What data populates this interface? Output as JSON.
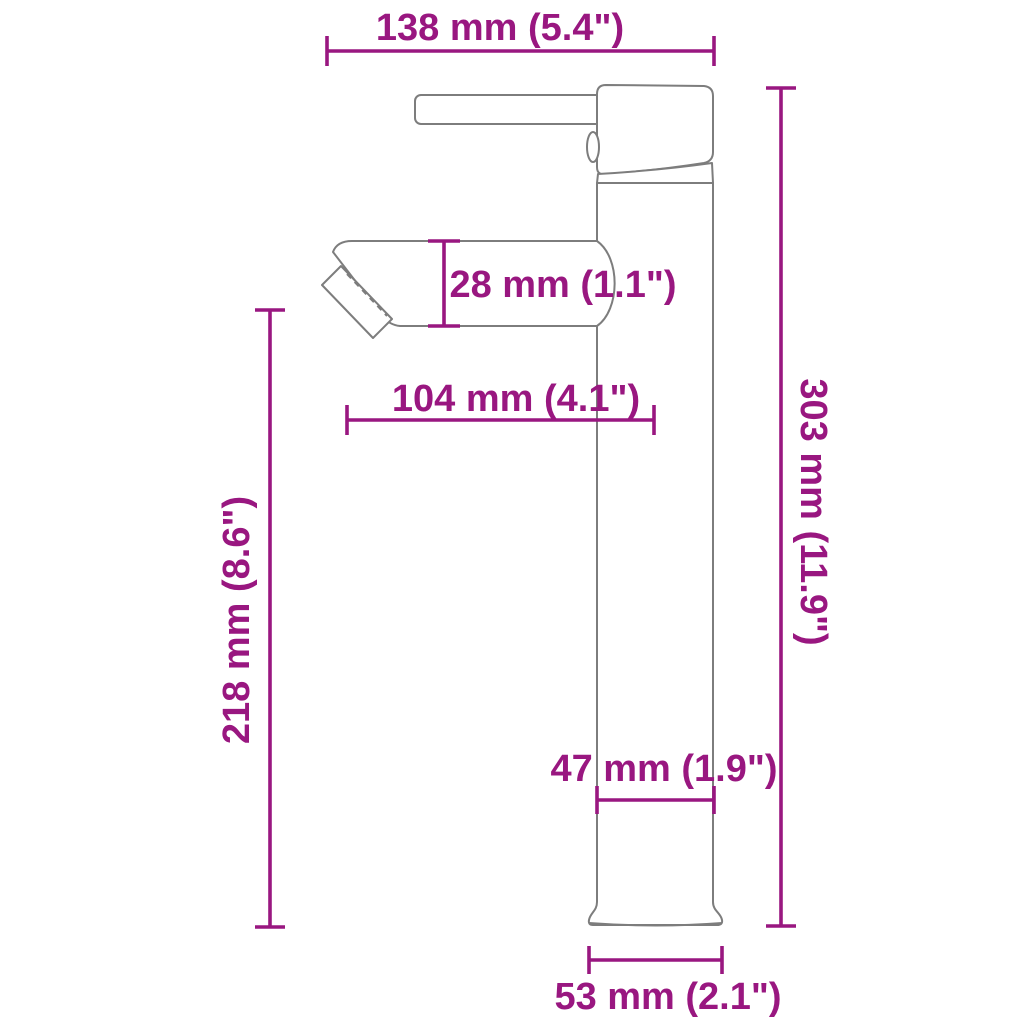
{
  "diagram": {
    "subject": "tall single-lever basin faucet side view dimension drawing",
    "accent_color": "#991780",
    "outline_color": "#7D7D7D",
    "background_color": "#FFFFFF",
    "dimensions": {
      "top_width": {
        "label": "138 mm (5.4\")",
        "mm": 138,
        "inches": 5.4,
        "orientation": "horizontal"
      },
      "spout_height": {
        "label": "28 mm (1.1\")",
        "mm": 28,
        "inches": 1.1,
        "orientation": "vertical"
      },
      "spout_reach": {
        "label": "104 mm (4.1\")",
        "mm": 104,
        "inches": 4.1,
        "orientation": "horizontal"
      },
      "spout_to_base_height": {
        "label": "218 mm (8.6\")",
        "mm": 218,
        "inches": 8.6,
        "orientation": "vertical"
      },
      "total_height": {
        "label": "303 mm (11.9\")",
        "mm": 303,
        "inches": 11.9,
        "orientation": "vertical"
      },
      "body_width": {
        "label": "47 mm (1.9\")",
        "mm": 47,
        "inches": 1.9,
        "orientation": "horizontal"
      },
      "base_width": {
        "label": "53 mm (2.1\")",
        "mm": 53,
        "inches": 2.1,
        "orientation": "horizontal"
      }
    }
  }
}
